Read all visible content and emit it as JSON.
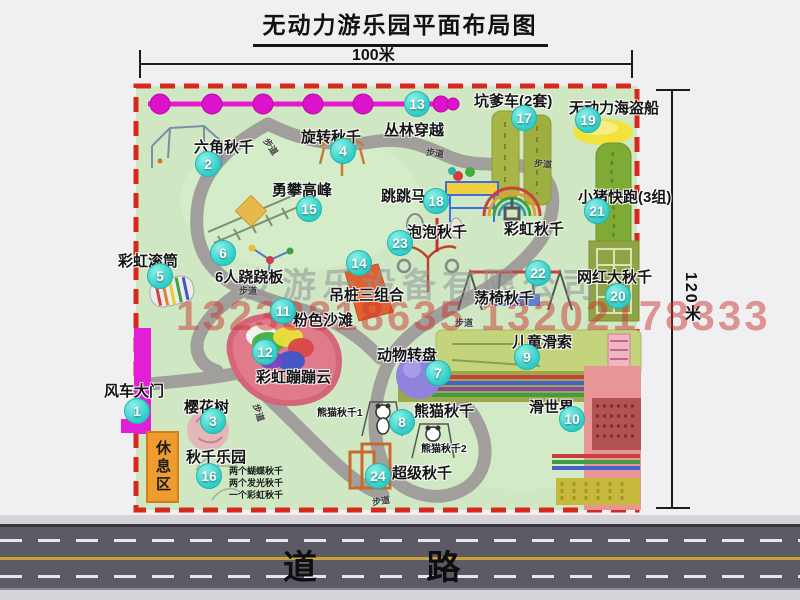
{
  "title": "无动力游乐园平面布局图",
  "dimensions": {
    "width_label": "100米",
    "height_label": "120米"
  },
  "road": {
    "label": "道 路"
  },
  "watermark": {
    "company": "安游乐设备有限公司",
    "phone": "13233818635 13202178333"
  },
  "rest_area_label": "休息区",
  "path_label": "步道",
  "extra_labels": {
    "rainbow_swing": "彩虹秋千",
    "panda_swing_1": "熊猫秋千1",
    "panda_swing_2": "熊猫秋千2"
  },
  "attractions": [
    {
      "num": "1",
      "label": "风车大门"
    },
    {
      "num": "2",
      "label": "六角秋千"
    },
    {
      "num": "3",
      "label": "樱花树"
    },
    {
      "num": "4",
      "label": "旋转秋千"
    },
    {
      "num": "5",
      "label": "彩虹滚筒"
    },
    {
      "num": "6",
      "label": "6人跷跷板"
    },
    {
      "num": "7",
      "label": "动物转盘"
    },
    {
      "num": "8",
      "label": "熊猫秋千"
    },
    {
      "num": "9",
      "label": "儿童滑索"
    },
    {
      "num": "10",
      "label": "滑世界"
    },
    {
      "num": "11",
      "label": "粉色沙滩"
    },
    {
      "num": "12",
      "label": "彩虹蹦蹦云"
    },
    {
      "num": "13",
      "label": "丛林穿越"
    },
    {
      "num": "14",
      "label": "吊桩三组合"
    },
    {
      "num": "15",
      "label": "勇攀高峰"
    },
    {
      "num": "16",
      "label": "秋千乐园",
      "notes": [
        "两个蝴蝶秋千",
        "两个发光秋千",
        "一个彩虹秋千"
      ]
    },
    {
      "num": "17",
      "label": "坑爹车(2套)"
    },
    {
      "num": "18",
      "label": "跳跳马"
    },
    {
      "num": "19",
      "label": "无动力海盗船"
    },
    {
      "num": "20",
      "label": "网红大秋千"
    },
    {
      "num": "21",
      "label": "小猪快跑(3组)"
    },
    {
      "num": "22",
      "label": "荡椅秋千"
    },
    {
      "num": "23",
      "label": "泡泡秋千"
    },
    {
      "num": "24",
      "label": "超级秋千"
    }
  ],
  "colors": {
    "park_green": "#cfe8c3",
    "border_red": "#d8281e",
    "badge_teal": "#3ed8d2",
    "zipline_magenta": "#e718ce",
    "gate_magenta": "#e31fd6",
    "rest_orange": "#ef9b2d",
    "road_gray": "#5c5a64"
  }
}
